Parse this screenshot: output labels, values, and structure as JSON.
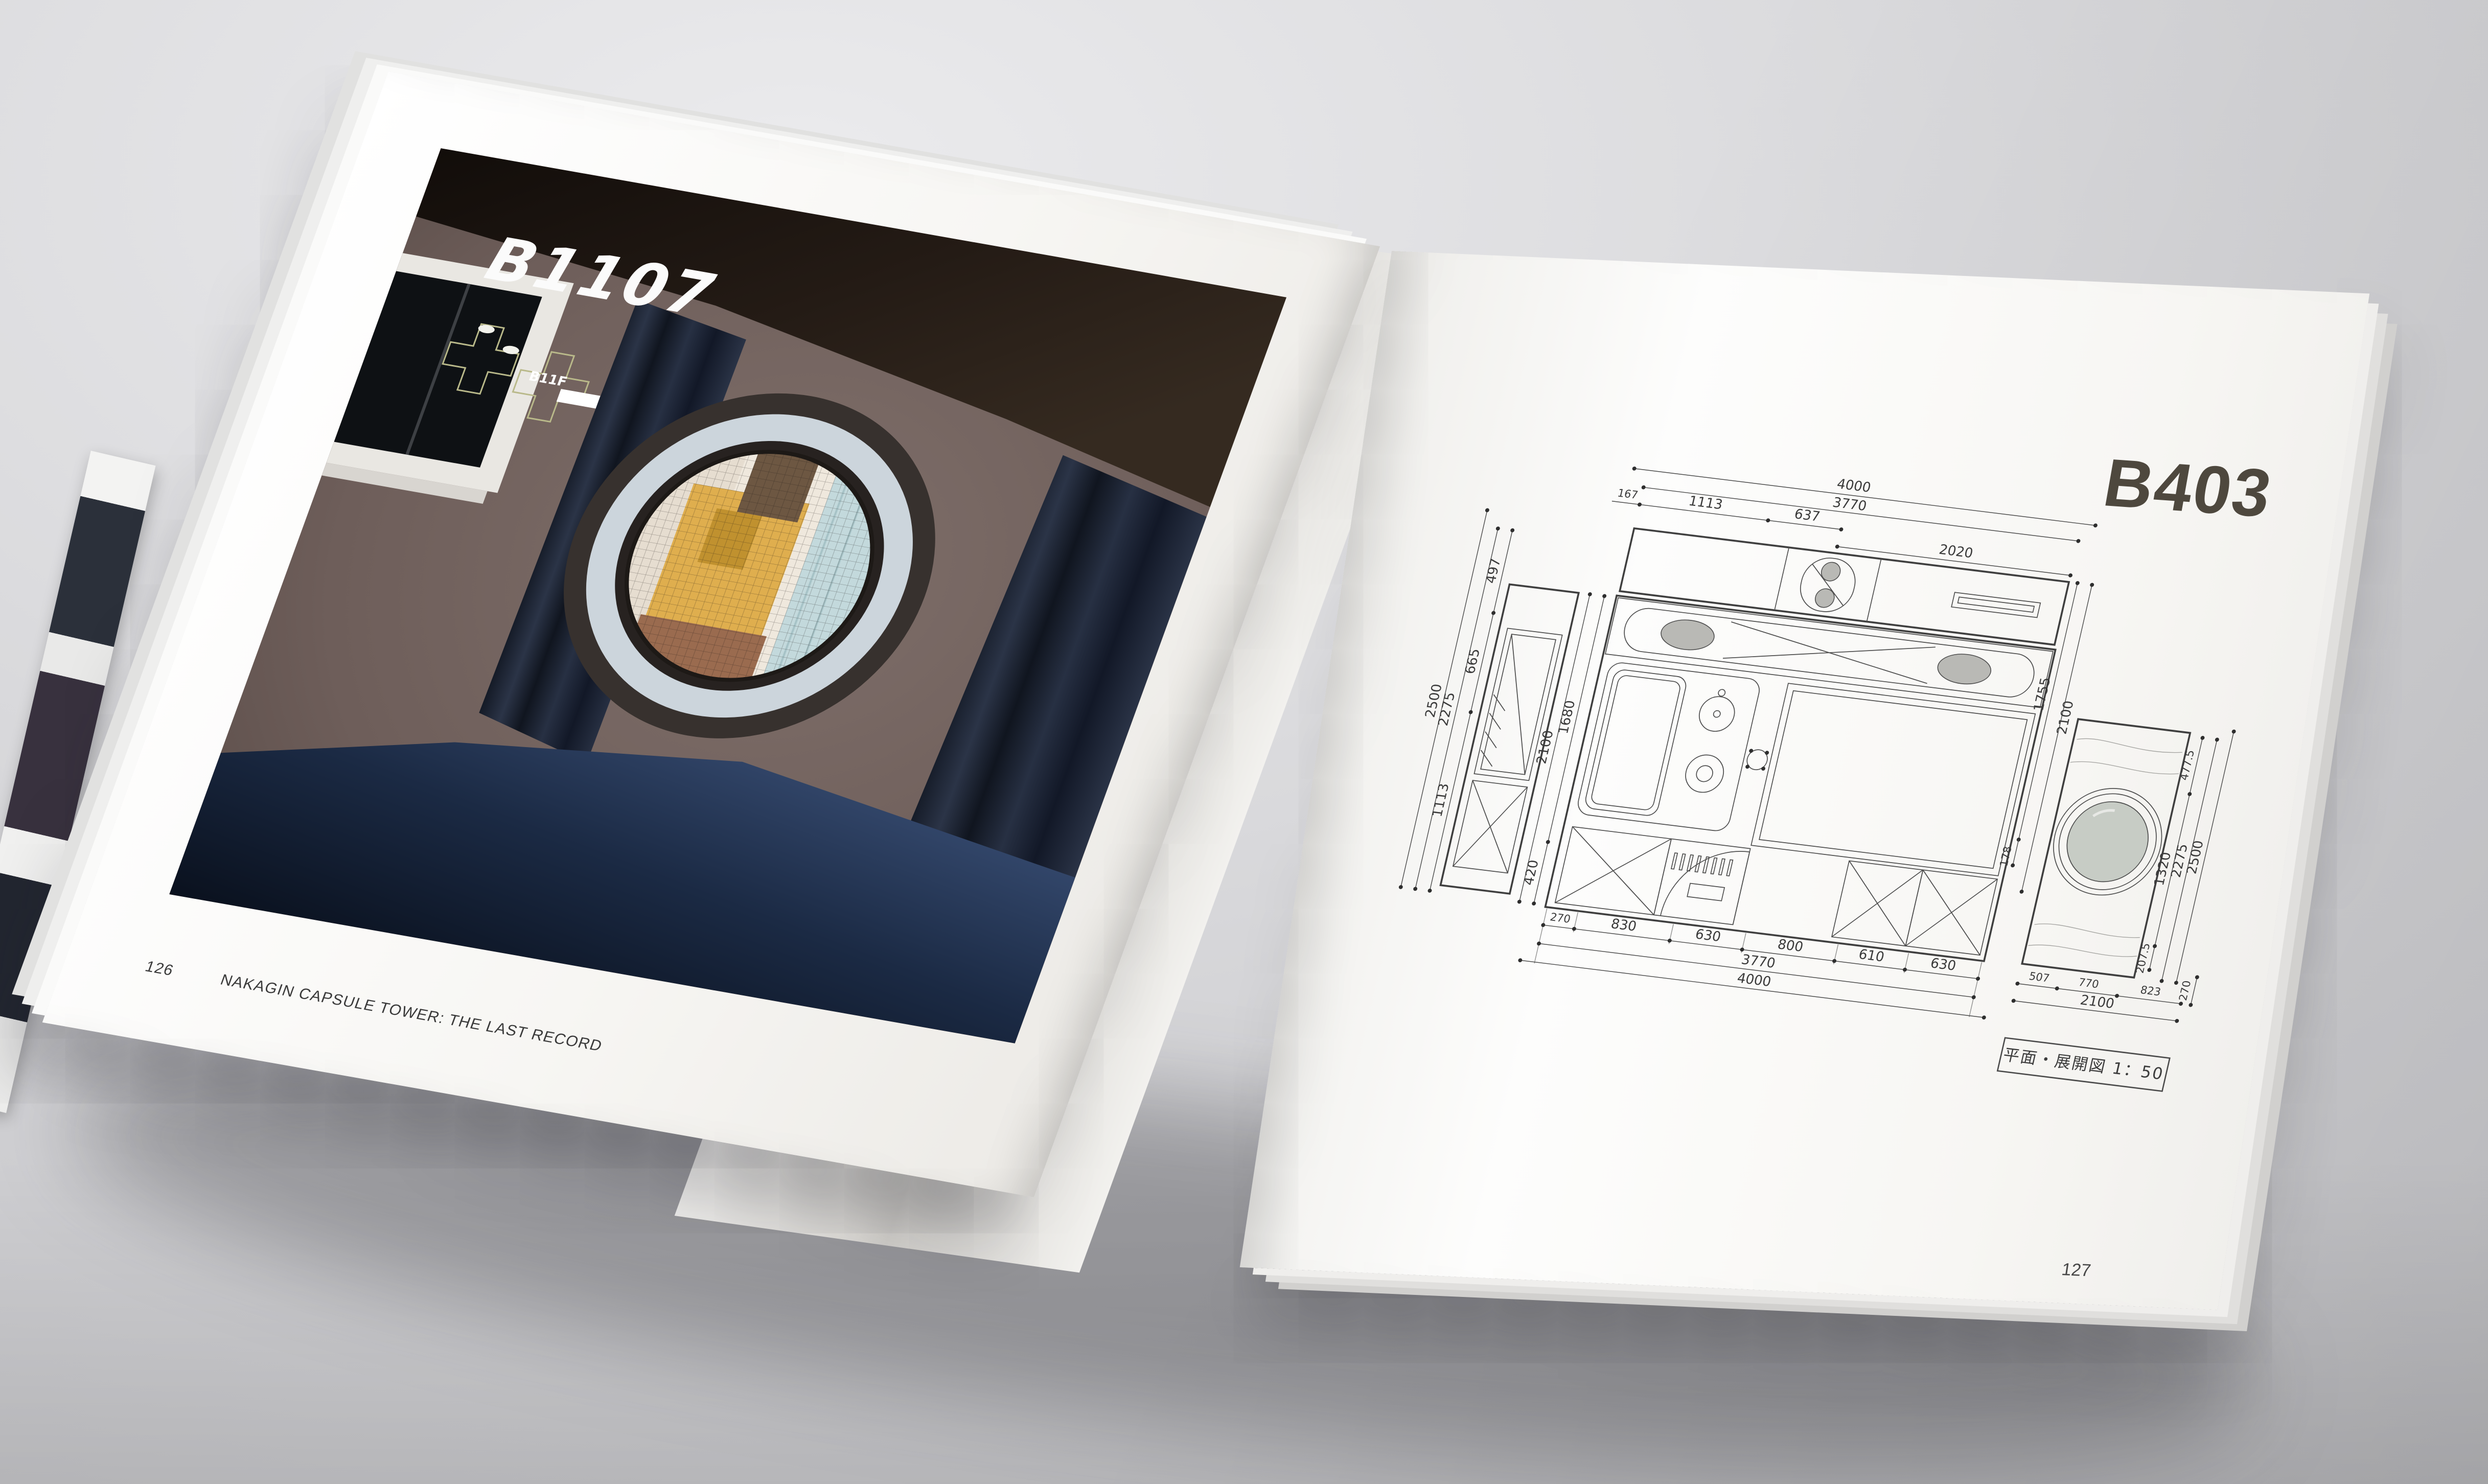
{
  "colors": {
    "desk": "#d3d3d6",
    "desk-dark": "#bdbdc1",
    "paper": "#f7f6f3",
    "paper-shade": "#eceae6",
    "ink": "#3a3a3a",
    "line": "#4b4b4b",
    "plan-fill": "#b9b9b5",
    "photo-wall": "#6e5e5a",
    "photo-ceiling": "#1b1410",
    "photo-curtain": "#1d2432",
    "photo-floor": "#14213a",
    "porthole-bezel": "#37312e",
    "porthole-ring": "#ccd5dc",
    "porthole-glass": "#c7ccc5",
    "city-yellow": "#dfae4e",
    "city-white": "#efe8dd",
    "city-blue": "#c3d9dc",
    "city-brick": "#6d5742",
    "title-ink": "#4e483e",
    "logo-olive": "#b9b98a"
  },
  "left_page": {
    "capsule_id": "B1107",
    "logo_label": "B11F",
    "page_number": "126",
    "caption": "NAKAGIN CAPSULE TOWER: THE LAST RECORD"
  },
  "right_page": {
    "capsule_id": "B403",
    "page_number": "127",
    "scale_label": "平面・展開図 1：50",
    "plan": {
      "dims_top": {
        "overall": "4000",
        "inner": "3770",
        "segments": [
          "1113",
          "637",
          "2020"
        ],
        "small": "167"
      },
      "dims_left": {
        "overall": "2500",
        "inner": "2275",
        "segments": [
          "497",
          "665",
          "1113"
        ]
      },
      "dims_left_lower": {
        "overall": "2100",
        "segments": [
          "1680",
          "420"
        ]
      },
      "dims_bottom": {
        "segments": [
          "270",
          "830",
          "630",
          "800",
          "610",
          "630"
        ],
        "inner": "3770",
        "overall": "4000"
      },
      "dims_right_upper": [
        "1755",
        "2100",
        "178"
      ],
      "dims_right_far": {
        "segments": [
          "477.5",
          "1320",
          "207.5"
        ],
        "inner": "2275",
        "overall": "2500"
      },
      "dims_bottom_right": {
        "segments": [
          "507",
          "770",
          "823"
        ],
        "overall": "2100",
        "side": "270"
      }
    }
  }
}
